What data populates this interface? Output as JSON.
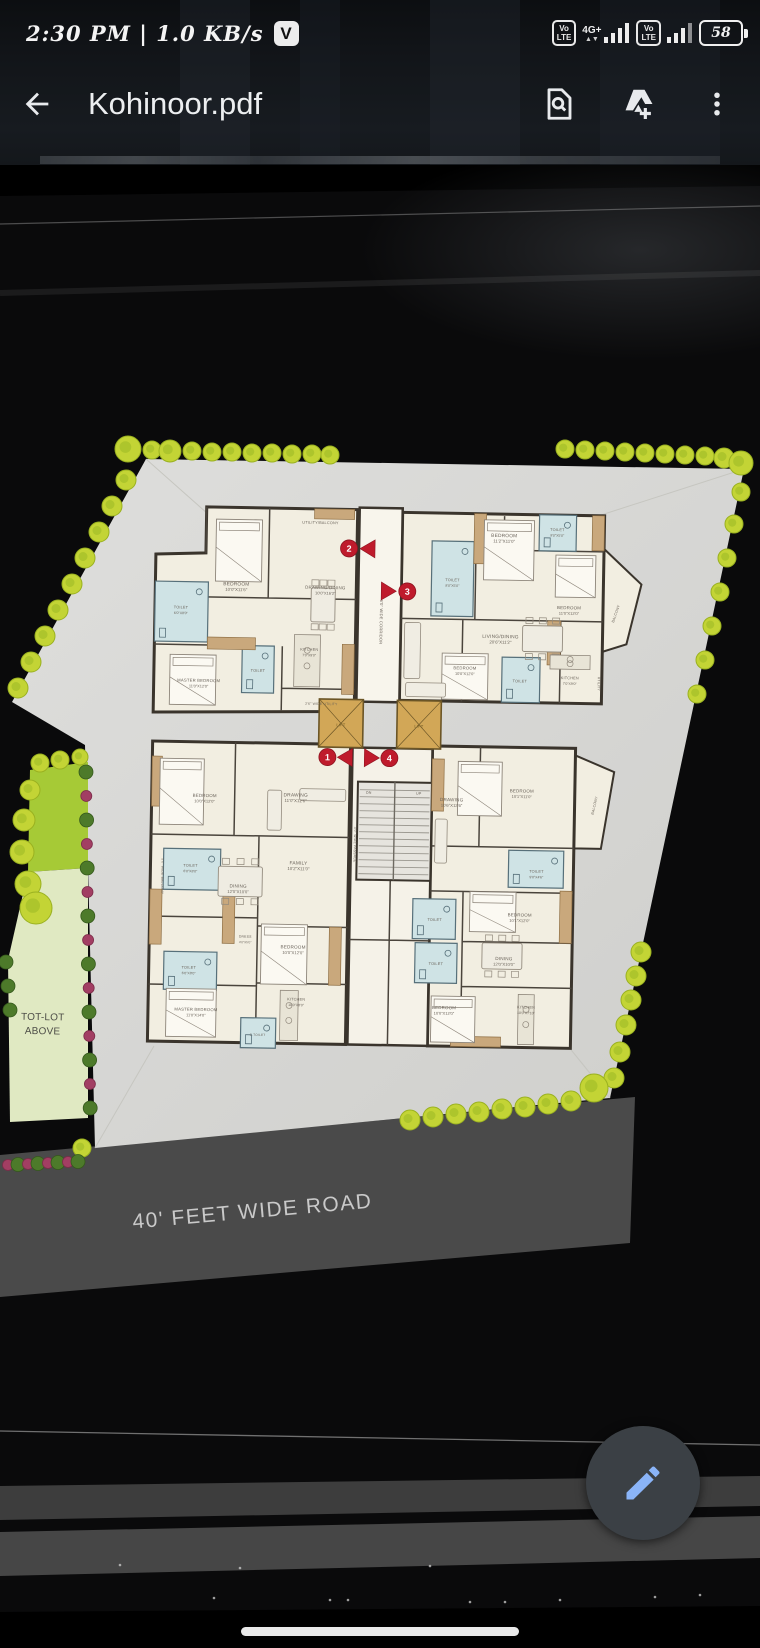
{
  "status_bar": {
    "time_and_speed": "2:30 PM | 1.0 KB/s",
    "notification_badge": "V",
    "volte_line1": "Vo",
    "volte_line2": "LTE",
    "data_type": "4G+",
    "battery_percent": "58"
  },
  "app_bar": {
    "title": "Kohinoor.pdf"
  },
  "floorplan": {
    "road_label": "40' FEET WIDE ROAD",
    "colors": {
      "site_paper": "#d9d9d6",
      "floor_cream": "#f2eee1",
      "wall": "#3a342c",
      "toilet_blue": "#cfe3e5",
      "wardrobe_tan": "#c9a87c",
      "lift_orange": "#d2a757",
      "tree_green": "#c3d435",
      "bush_green": "#4d7a2a",
      "bush_magenta": "#a23e63",
      "road_gray": "#4a4a4a",
      "marker_red": "#bf1b2c",
      "fab_gray": "#3b4045",
      "fab_pen_blue": "#8ab4f8"
    },
    "markers": [
      {
        "n": "2",
        "cx": 345,
        "cy": 549,
        "tri": "371,540 371,558 356,549"
      },
      {
        "n": "3",
        "cx": 404,
        "cy": 591,
        "tri": "378,582 378,600 393,591"
      },
      {
        "n": "1",
        "cx": 327,
        "cy": 758,
        "tri": "352,749 352,767 337,758"
      },
      {
        "n": "4",
        "cx": 389,
        "cy": 758,
        "tri": "364,749 364,767 379,758"
      }
    ],
    "labels": [
      {
        "t": "UTILITY/BALCONY",
        "x": 316,
        "y": 525,
        "s": 3.8
      },
      {
        "t": "BEDROOM",
        "d": "10'0\"X11'6\"",
        "x": 233,
        "y": 588
      },
      {
        "t": "DRAWING/DINING",
        "d": "10'0\"X16'2\"",
        "x": 322,
        "y": 590,
        "s": 4.4
      },
      {
        "t": "TOILET",
        "d": "6'0\"X8'0\"",
        "x": 178,
        "y": 612,
        "s": 3.8
      },
      {
        "t": "MASTER BEDROOM",
        "d": "11'0\"X12'0\"",
        "x": 197,
        "y": 685,
        "s": 4.2
      },
      {
        "t": "TOILET",
        "x": 256,
        "y": 674,
        "s": 3.8
      },
      {
        "t": "KITCHEN",
        "d": "7'0\"X9'0\"",
        "x": 307,
        "y": 652,
        "s": 3.8
      },
      {
        "t": "2'6\" WIDE UTILITY",
        "x": 320,
        "y": 706,
        "s": 3.4
      },
      {
        "t": "TOILET",
        "d": "8'0\"X5'0\"",
        "x": 449,
        "y": 580,
        "s": 3.8
      },
      {
        "t": "BEDROOM",
        "d": "11'2\"X11'0\"",
        "x": 500,
        "y": 535,
        "s": 4.8
      },
      {
        "t": "TOILET",
        "d": "8'0\"X5'0\"",
        "x": 553,
        "y": 528,
        "s": 3.8
      },
      {
        "t": "BEDROOM",
        "d": "11'0\"X12'0\"",
        "x": 566,
        "y": 606,
        "s": 4.4
      },
      {
        "t": "LIVING/DINING",
        "d": "20'6\"X11'2\"",
        "x": 498,
        "y": 636,
        "s": 4.8
      },
      {
        "t": "BALCONY",
        "x": 614,
        "y": 610,
        "r": -72,
        "s": 3.6
      },
      {
        "t": "BEDROOM",
        "d": "10'0\"X12'0\"",
        "x": 463,
        "y": 668,
        "s": 4.2
      },
      {
        "t": "TOILET",
        "x": 518,
        "y": 680,
        "s": 3.8
      },
      {
        "t": "KITCHEN",
        "d": "7'0\"X9'0\"",
        "x": 568,
        "y": 676,
        "s": 3.8
      },
      {
        "t": "UTILITY",
        "x": 596,
        "y": 680,
        "r": 90,
        "s": 3.4
      },
      {
        "t": "6'0\" WIDE CORRIDOR",
        "x": 377,
        "y": 622,
        "r": 90,
        "s": 4
      },
      {
        "t": "LIFT",
        "x": 340,
        "y": 727,
        "s": 4,
        "c": "#6d561f"
      },
      {
        "t": "LIFT",
        "x": 418,
        "y": 727,
        "s": 4,
        "c": "#6d561f"
      },
      {
        "t": "DN",
        "x": 369,
        "y": 794,
        "s": 3.6
      },
      {
        "t": "UP",
        "x": 419,
        "y": 794,
        "s": 3.6
      },
      {
        "t": "4'0\" WIDE PASSAGE",
        "x": 355,
        "y": 845,
        "r": 90,
        "s": 3.4
      },
      {
        "t": "BEDROOM",
        "d": "10'0\"X12'0\"",
        "x": 205,
        "y": 800,
        "s": 4.4
      },
      {
        "t": "DRAWING",
        "d": "11'0\"X12'6\"",
        "x": 296,
        "y": 798,
        "s": 4.8
      },
      {
        "t": "TOILET",
        "d": "6'0\"X8'0\"",
        "x": 192,
        "y": 870,
        "s": 3.8
      },
      {
        "t": "FAMILY",
        "d": "10'2\"X11'0\"",
        "x": 300,
        "y": 866,
        "s": 4.8
      },
      {
        "t": "5'0\" WIDE BALCONY",
        "x": 163,
        "y": 880,
        "r": 90,
        "s": 3.4
      },
      {
        "t": "DINING",
        "d": "12'0\"X10'0\"",
        "x": 240,
        "y": 890,
        "s": 4.6
      },
      {
        "t": "TOILET",
        "d": "6'0\"X8'0\"",
        "x": 192,
        "y": 972,
        "s": 3.8
      },
      {
        "t": "DRESS",
        "d": "4'0\"X5'0\"",
        "x": 248,
        "y": 940,
        "s": 3.4
      },
      {
        "t": "MASTER BEDROOM",
        "d": "11'0\"X14'0\"",
        "x": 200,
        "y": 1014,
        "s": 4.2
      },
      {
        "t": "BEDROOM",
        "d": "10'0\"X12'0\"",
        "x": 296,
        "y": 950,
        "s": 4.6
      },
      {
        "t": "KITCHEN",
        "d": "10'0\"X8'0\"",
        "x": 300,
        "y": 1002,
        "s": 3.8
      },
      {
        "t": "C.TOILET",
        "x": 262,
        "y": 1038,
        "s": 3.2
      },
      {
        "t": "DRAWING",
        "d": "10'6\"X12'6\"",
        "x": 452,
        "y": 800,
        "s": 4.6
      },
      {
        "t": "BEDROOM",
        "d": "10'1\"X11'0\"",
        "x": 522,
        "y": 790,
        "s": 4.4
      },
      {
        "t": "TOILET",
        "d": "9'0\"X4'6\"",
        "x": 538,
        "y": 870,
        "s": 3.8
      },
      {
        "t": "BEDROOM",
        "d": "10'1\"X12'0\"",
        "x": 522,
        "y": 914,
        "s": 4.4
      },
      {
        "t": "TOILET",
        "x": 437,
        "y": 920,
        "s": 3.8
      },
      {
        "t": "TOILET",
        "x": 439,
        "y": 964,
        "s": 3.8
      },
      {
        "t": "DINING",
        "d": "12'0\"X10'0\"",
        "x": 507,
        "y": 958,
        "s": 4.6
      },
      {
        "t": "BEDROOM",
        "d": "10'0\"X12'0\"",
        "x": 448,
        "y": 1008,
        "s": 4.4
      },
      {
        "t": "KITCHEN",
        "d": "10'0\"X7'10\"",
        "x": 530,
        "y": 1006,
        "s": 3.8
      },
      {
        "t": "BALCONY",
        "x": 596,
        "y": 802,
        "r": -78,
        "s": 3.6
      },
      {
        "t": "TOT-LOT",
        "x": 47,
        "y": 1026,
        "s": 10,
        "c": "#4c4c46"
      },
      {
        "t": "ABOVE",
        "x": 47,
        "y": 1040,
        "s": 10,
        "c": "#4c4c46"
      }
    ]
  }
}
